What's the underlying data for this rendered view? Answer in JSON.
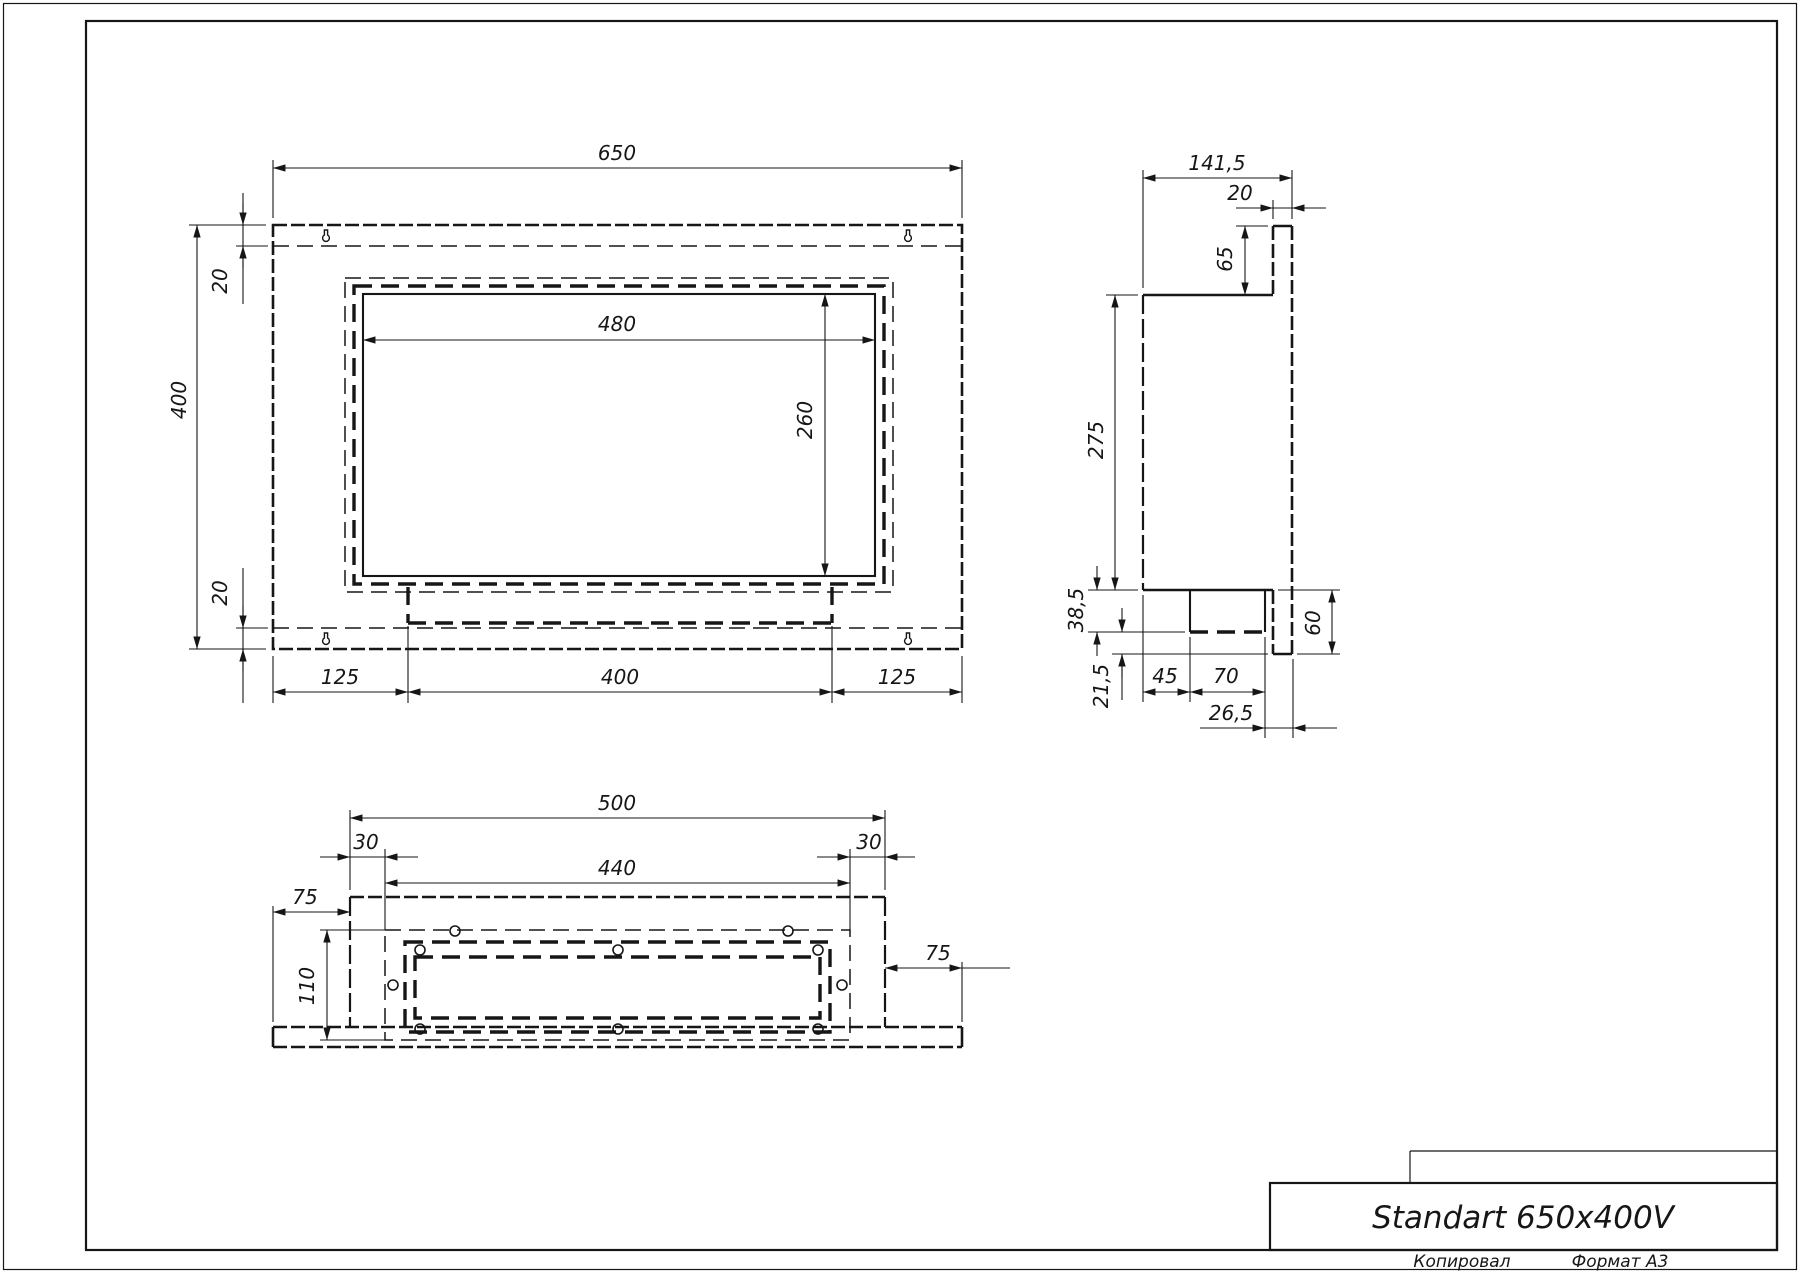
{
  "drawing": {
    "title": "Standart 650x400V",
    "footer": {
      "copied": "Копировал",
      "format": "Формат А3"
    },
    "colors": {
      "ink": "#161616",
      "paper": "#ffffff"
    },
    "front_view": {
      "dims": {
        "width": "650",
        "height": "400",
        "top_inset": "20",
        "bottom_inset": "20",
        "opening_width": "480",
        "opening_height": "260",
        "bottom_left": "125",
        "bottom_center": "400",
        "bottom_right": "125"
      }
    },
    "side_view": {
      "dims": {
        "total_depth": "141,5",
        "plate_thickness": "20",
        "top_to_body": "65",
        "body_height": "275",
        "burner_drop": "38,5",
        "lower_drop": "21,5",
        "plate_below_body": "60",
        "front_offset": "45",
        "burner_depth": "70",
        "back_offset": "26,5"
      }
    },
    "bottom_view": {
      "dims": {
        "body_width": "500",
        "inset_left": "30",
        "inset_right": "30",
        "tray_width": "440",
        "flange_left": "75",
        "flange_right": "75",
        "tray_depth": "110"
      }
    }
  }
}
